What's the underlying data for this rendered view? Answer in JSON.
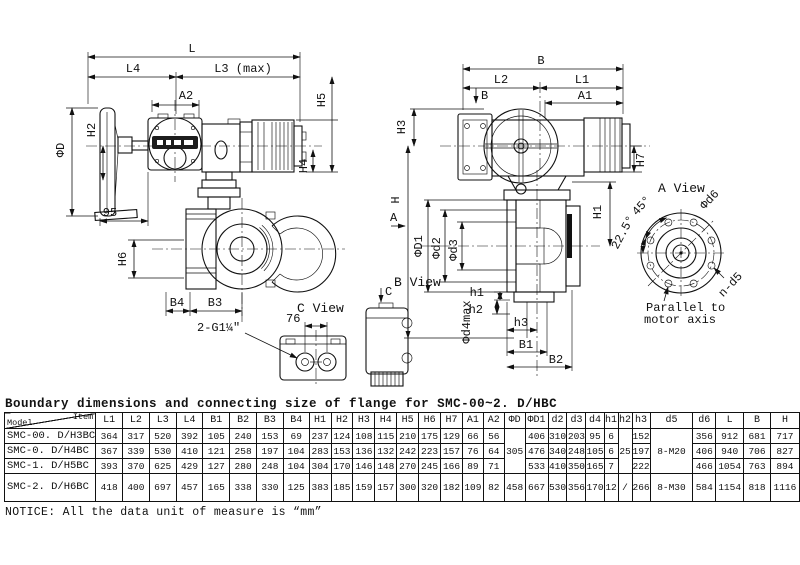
{
  "title": "Boundary dimensions and connecting size of flange for SMC-00~2. D/HBC",
  "notice": "NOTICE: All the data unit of measure is “mm”",
  "drawing": {
    "labels": {
      "L": "L",
      "L4": "L4",
      "L3max": "L3 (max)",
      "A2": "A2",
      "H5": "H5",
      "H4": "H4",
      "H2": "H2",
      "phiD": "ΦD",
      "n95": "95",
      "H6": "H6",
      "B4": "B4",
      "B3": "B3",
      "thread": "2-G1¼\"",
      "n76": "76",
      "cview": "C View",
      "bview": "B View",
      "amark": "A",
      "bmark": "B",
      "cmark": "C",
      "B": "B",
      "L2": "L2",
      "L1": "L1",
      "A1": "A1",
      "H3": "H3",
      "H": "H",
      "H1": "H1",
      "H7": "H7",
      "phiD1": "ΦD1",
      "phid2": "Φd2",
      "phid3": "Φd3",
      "phid4": "Φd4max",
      "h1": "h1",
      "h2": "h2",
      "h3": "h3",
      "B1": "B1",
      "B2": "B2",
      "aview": "A View",
      "phid6": "Φd6",
      "deg45": "45°",
      "deg225": "22.5°",
      "nd5": "n-d5",
      "par1": "Parallel to",
      "par2": "motor axis"
    }
  },
  "table": {
    "model_header": "Model",
    "item_header": "Item",
    "columns": [
      "L1",
      "L2",
      "L3",
      "L4",
      "B1",
      "B2",
      "B3",
      "B4",
      "H1",
      "H2",
      "H3",
      "H4",
      "H5",
      "H6",
      "H7",
      "A1",
      "A2",
      "ΦD",
      "ΦD1",
      "d2",
      "d3",
      "d4",
      "h1",
      "h2",
      "h3",
      "d5",
      "d6",
      "L",
      "B",
      "H"
    ],
    "rows": [
      {
        "model": "SMC-00. D/H3BC",
        "values": [
          "364",
          "317",
          "520",
          "392",
          "105",
          "240",
          "153",
          "69",
          "237",
          "124",
          "108",
          "115",
          "210",
          "175",
          "129",
          "66",
          "56",
          {
            "v": "305",
            "rowspan": 3
          },
          "406",
          "310",
          "203",
          "95",
          "6",
          {
            "v": "25",
            "rowspan": 3
          },
          "152",
          {
            "v": "8-M20",
            "rowspan": 3
          },
          "356",
          "912",
          "681",
          "717"
        ]
      },
      {
        "model": "SMC-0. D/H4BC",
        "values": [
          "367",
          "339",
          "530",
          "410",
          "121",
          "258",
          "197",
          "104",
          "283",
          "153",
          "136",
          "132",
          "242",
          "223",
          "157",
          "76",
          "64",
          "476",
          "340",
          "248",
          "105",
          "6",
          "197",
          "406",
          "940",
          "706",
          "827"
        ]
      },
      {
        "model": "SMC-1. D/H5BC",
        "values": [
          "393",
          "370",
          "625",
          "429",
          "127",
          "280",
          "248",
          "104",
          "304",
          "170",
          "146",
          "148",
          "270",
          "245",
          "166",
          "89",
          "71",
          "533",
          "410",
          "350",
          "165",
          "7",
          "222",
          "466",
          "1054",
          "763",
          "894"
        ]
      },
      {
        "model": "SMC-2. D/H6BC",
        "values": [
          "418",
          "400",
          "697",
          "457",
          "165",
          "338",
          "330",
          "125",
          "383",
          "185",
          "159",
          "157",
          "300",
          "320",
          "182",
          "109",
          "82",
          "458",
          "667",
          "530",
          "356",
          "170",
          "12",
          "/",
          "266",
          "8-M30",
          "584",
          "1154",
          "818",
          "1116"
        ]
      }
    ]
  }
}
